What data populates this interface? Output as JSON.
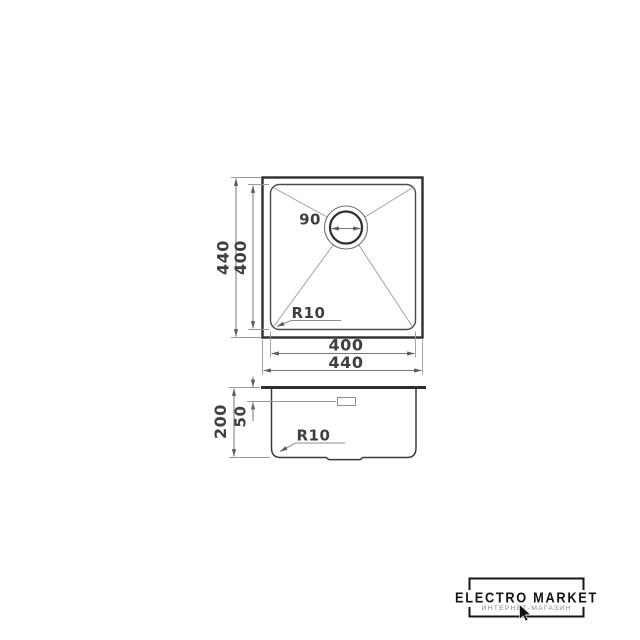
{
  "drawing": {
    "top_view": {
      "drain_diameter_label": "90",
      "outer_width_label": "440",
      "inner_width_label": "400",
      "outer_height_label": "440",
      "inner_height_label": "400",
      "corner_radius_label": "R10"
    },
    "side_view": {
      "total_height_label": "200",
      "overflow_depth_label": "50",
      "corner_radius_label": "R10"
    }
  },
  "logo": {
    "title": "ELECTRO MARKET",
    "subtitle": "ИНТЕРНЕТ-МАГАЗИН"
  },
  "colors": {
    "background": "#ffffff",
    "main_outline": "#2e2e2e",
    "secondary_line": "#4a4a4a",
    "dimension_line": "#777777",
    "dimension_text": "#3f3f3f",
    "logo_text": "#141414",
    "logo_subtitle": "#8a8a8a"
  }
}
